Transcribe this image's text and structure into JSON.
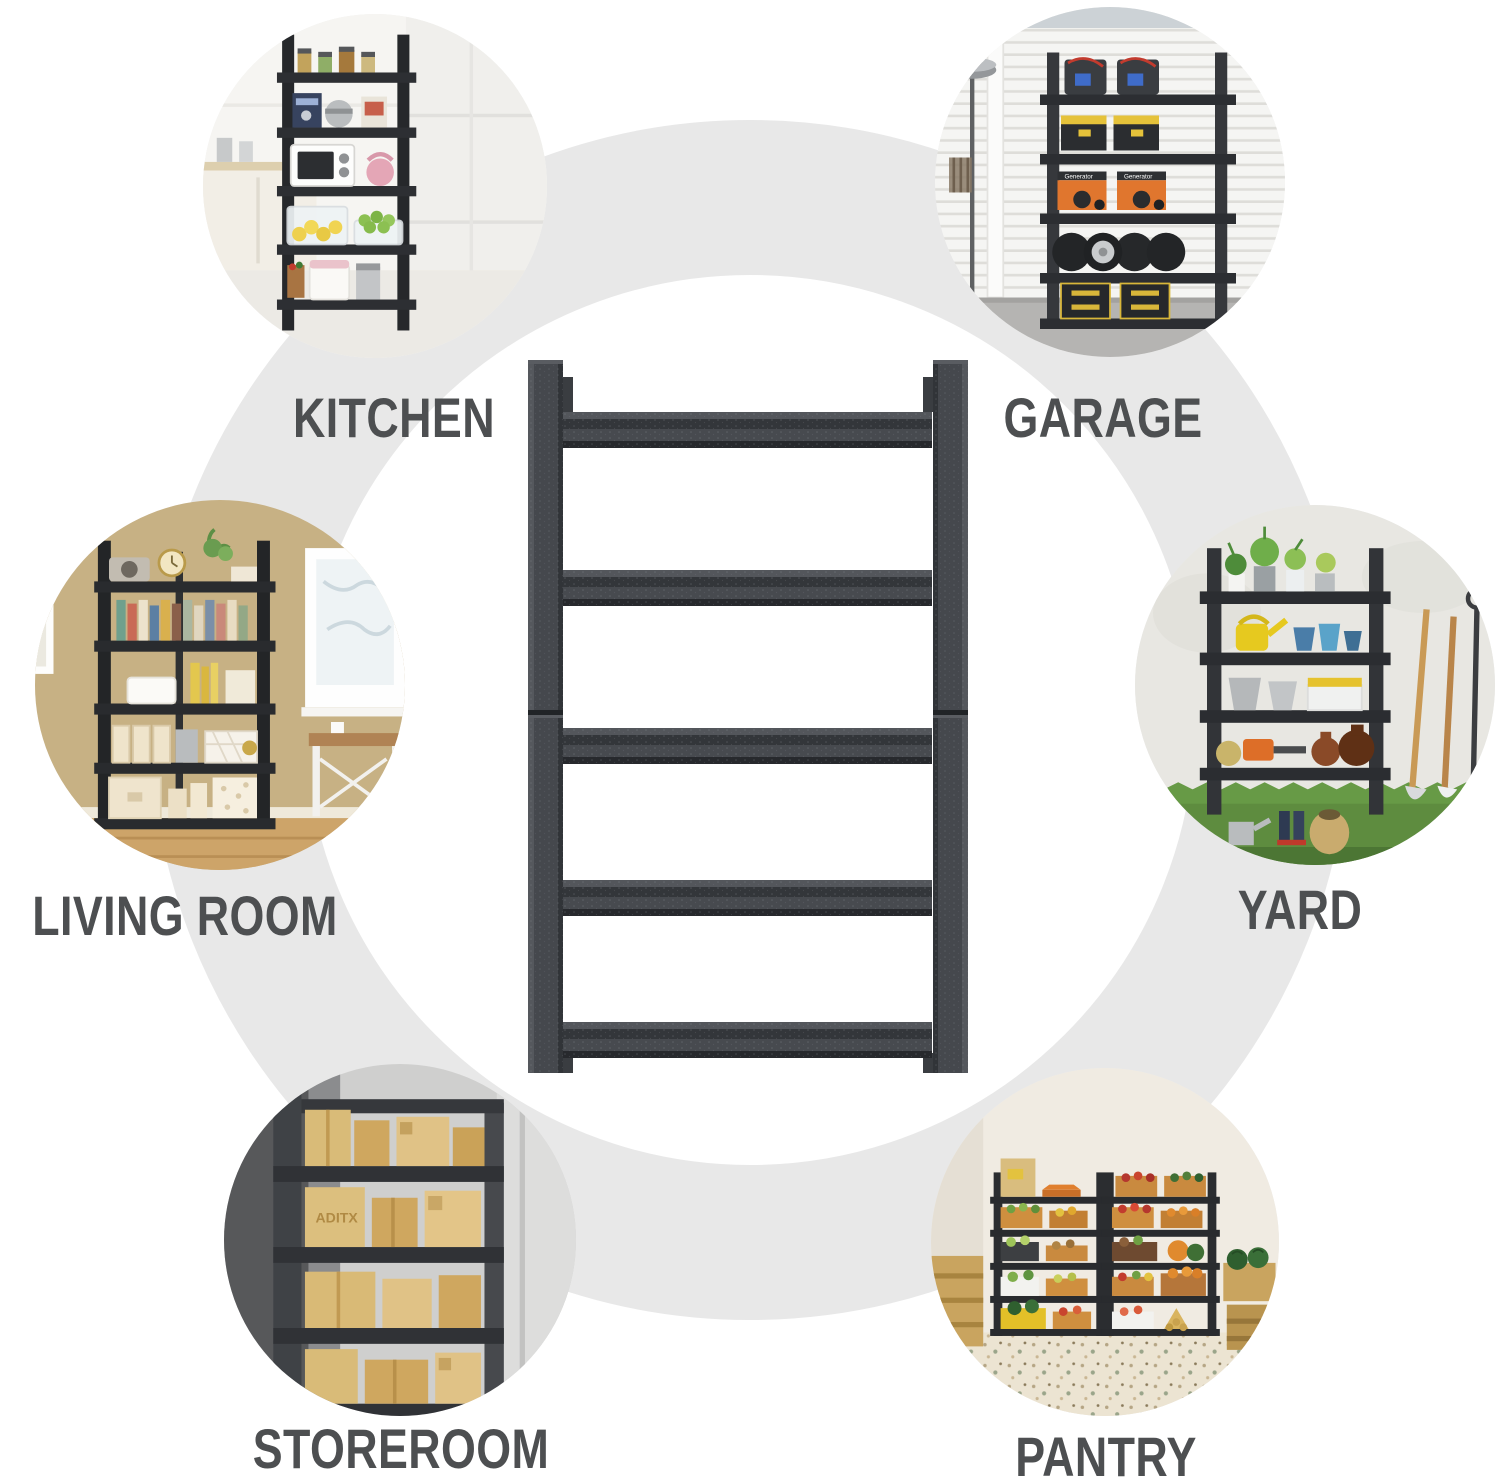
{
  "colors": {
    "background": "#ffffff",
    "ring": "#e8e8e8",
    "label_text": "#4d4f51",
    "rack_frame": "#3d4045"
  },
  "product": {
    "description": "dark grey metal 5-tier storage shelving frame shown from the side, two stacked sections with a middle joint"
  },
  "use_cases": [
    {
      "label": "KITCHEN",
      "position": "top-left",
      "scene": "black 5-tier rack in a white kitchen holding jars, coffee machine, silver pot, white microwave, pink kettle, lemons, green apples and storage bins"
    },
    {
      "label": "GARAGE",
      "position": "top-right",
      "generator_text": "Generator",
      "scene": "black 5-tier rack in front of a white roller door with jump-starter boxes, yellow-lid toolboxes, two orange generators, tires with a chrome rim and black-yellow drawer chests; floor lamp at left"
    },
    {
      "label": "LIVING ROOM",
      "position": "middle-left",
      "scene": "black 5-tier rack against a tan wall with speaker, clock and plant on top, a row of books, tissue box, file boxes and cream storage boxes; window and desk at right"
    },
    {
      "label": "YARD",
      "position": "middle-right",
      "scene": "black 5-tier rack outdoors on grass with potted plants on top, yellow watering can, blue pots, metal buckets, white tool box with yellow lid, orange chainsaw and clay jugs; shovels lean on the wall"
    },
    {
      "label": "STOREROOM",
      "position": "bottom-left",
      "box_text": "ADITX",
      "scene": "close-up of dark grey shelving stacked with tan cardboard boxes on four levels"
    },
    {
      "label": "PANTRY",
      "position": "bottom-right",
      "scene": "two black 5-tier racks filled with crates of fruit and vegetables on a terrazzo floor, wooden crates and watermelons at the sides"
    }
  ]
}
